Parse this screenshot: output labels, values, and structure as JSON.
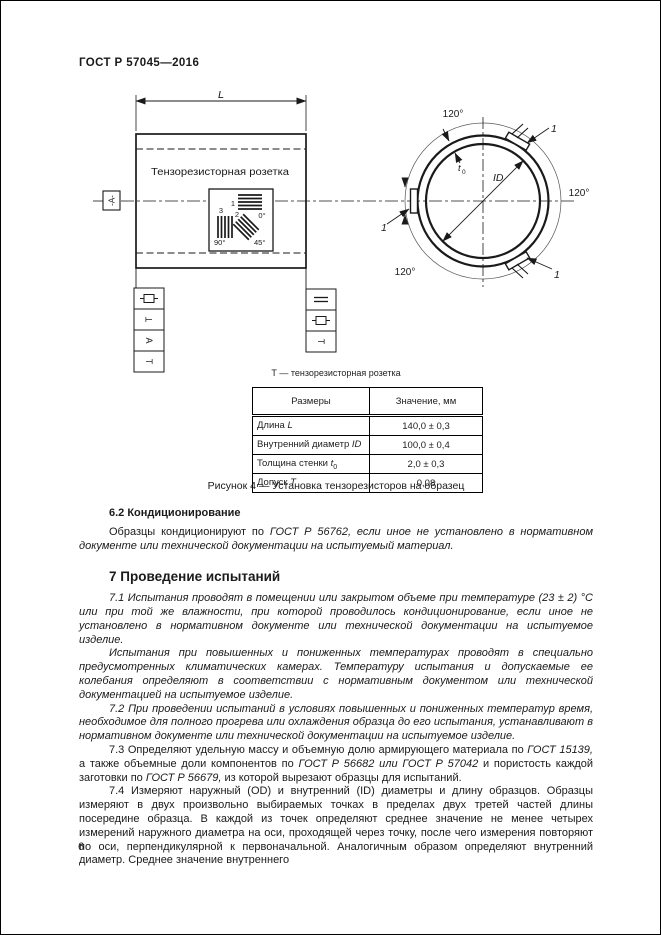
{
  "page": {
    "header": "ГОСТ Р 57045—2016",
    "number": "6"
  },
  "figure": {
    "left_view": {
      "length_label": "L",
      "rosette_title": "Тензорезисторная розетка",
      "datum_label": "-А-",
      "gauge1": {
        "num": "1",
        "angle": "0°"
      },
      "gauge2": {
        "num": "2",
        "angle": "45°"
      },
      "gauge3": {
        "num": "3",
        "angle": "90°"
      },
      "tol": {
        "t": "Т",
        "a": "А"
      }
    },
    "section_view": {
      "angle_labels": [
        "120°",
        "120°",
        "120°"
      ],
      "gauge_ref": "1",
      "wall_label": "t",
      "wall_sub": "0",
      "id_label": "ID"
    },
    "legend": "Т — тензорезисторная розетка",
    "caption": "Рисунок 4 — Установка тензорезисторов на образец"
  },
  "table": {
    "col1": "Размеры",
    "col2": "Значение, мм",
    "rows": [
      {
        "name": "Длина ",
        "sym": "L",
        "sub": "",
        "value": "140,0 ± 0,3"
      },
      {
        "name": "Внутренний диаметр ",
        "sym": "ID",
        "sub": "",
        "value": "100,0 ± 0,4"
      },
      {
        "name": "Толщина стенки ",
        "sym": "t",
        "sub": "0",
        "value": "2,0 ± 0,3"
      },
      {
        "name": "Допуск ",
        "sym": "Т",
        "sub": "",
        "value": "0,08"
      }
    ]
  },
  "sections": {
    "s62": {
      "title": "6.2 Кондиционирование",
      "p_a": "Образцы кондиционируют по ",
      "p_b": "ГОСТ Р 56762, если иное не установлено в нормативном документе или технической документации на испытуемый материал."
    },
    "s7": {
      "title": "7 Проведение испытаний",
      "p71": "7.1 Испытания проводят в помещении или закрытом объеме при температуре (23 ± 2) °С или при той же влажности, при которой проводилось кондиционирование, если иное не установлено в нормативном документе или технической документации на испытуемое изделие.",
      "p71b": "Испытания при повышенных и пониженных температурах проводят в специально предусмотренных климатических камерах. Температуру испытания и допускаемые ее колебания определяют в соответствии с нормативным документом или технической документацией на испытуемое изделие.",
      "p72": "7.2 При проведении испытаний в условиях повышенных и пониженных температур время, необходимое для полного прогрева или охлаждения образца до его испытания, устанавливают в нормативном документе или технической документации на испытуемое изделие.",
      "p73": {
        "a": "7.3 Определяют удельную массу и объемную долю армирующего материала по ",
        "b": "ГОСТ 15139,",
        "c": " а также объемные доли компонентов по ",
        "d": "ГОСТ Р 56682 или ГОСТ Р 57042",
        "e": " и пористость каждой заготовки по ",
        "f": "ГОСТ Р 56679,",
        "g": " из которой вырезают образцы для испытаний."
      },
      "p74": "7.4 Измеряют наружный (OD) и внутренний (ID) диаметры и длину образцов. Образцы измеряют в двух произвольно выбираемых точках в пределах двух третей частей длины посередине образца. В каждой из точек определяют среднее значение не менее четырех измерений наружного диаметра на оси, проходящей через точку, после чего измерения повторяют по оси, перпендикулярной к первоначальной. Аналогичным образом определяют внутренний диаметр. Среднее значение внутреннего"
    }
  }
}
